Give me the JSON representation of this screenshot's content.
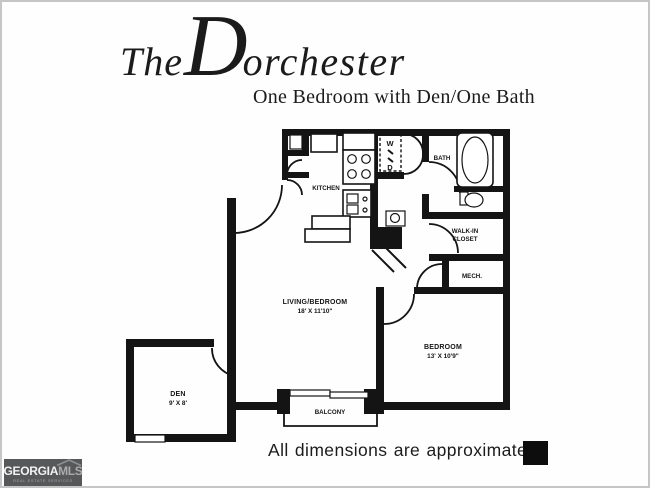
{
  "page": {
    "title_the": "The",
    "title_d": "D",
    "title_rest": "orchester",
    "subtitle": "One Bedroom with Den/One Bath",
    "footnote": "All dimensions are approximate"
  },
  "floorplan": {
    "kitchen": {
      "label": "KITCHEN"
    },
    "washer_dryer": {
      "top": "W",
      "bottom": "D"
    },
    "bath": {
      "label": "BATH"
    },
    "walkin_closet": {
      "line1": "WALK-IN",
      "line2": "CLOSET"
    },
    "mech": {
      "label": "MECH."
    },
    "living_bedroom": {
      "label": "LIVING/BEDROOM",
      "dims": "18' X 11'10\""
    },
    "bedroom": {
      "label": "BEDROOM",
      "dims": "13' X 10'9\""
    },
    "den": {
      "label": "DEN",
      "dims": "9' X 8'"
    },
    "balcony": {
      "label": "BALCONY"
    }
  },
  "branding": {
    "logo_main": "GEORGIA",
    "logo_accent": "MLS",
    "logo_sub": "REAL ESTATE SERVICES"
  },
  "colors": {
    "ink": "#141414",
    "paper": "#fefefe",
    "logo_bg": "#57585a",
    "logo_accent": "#a9abad"
  }
}
